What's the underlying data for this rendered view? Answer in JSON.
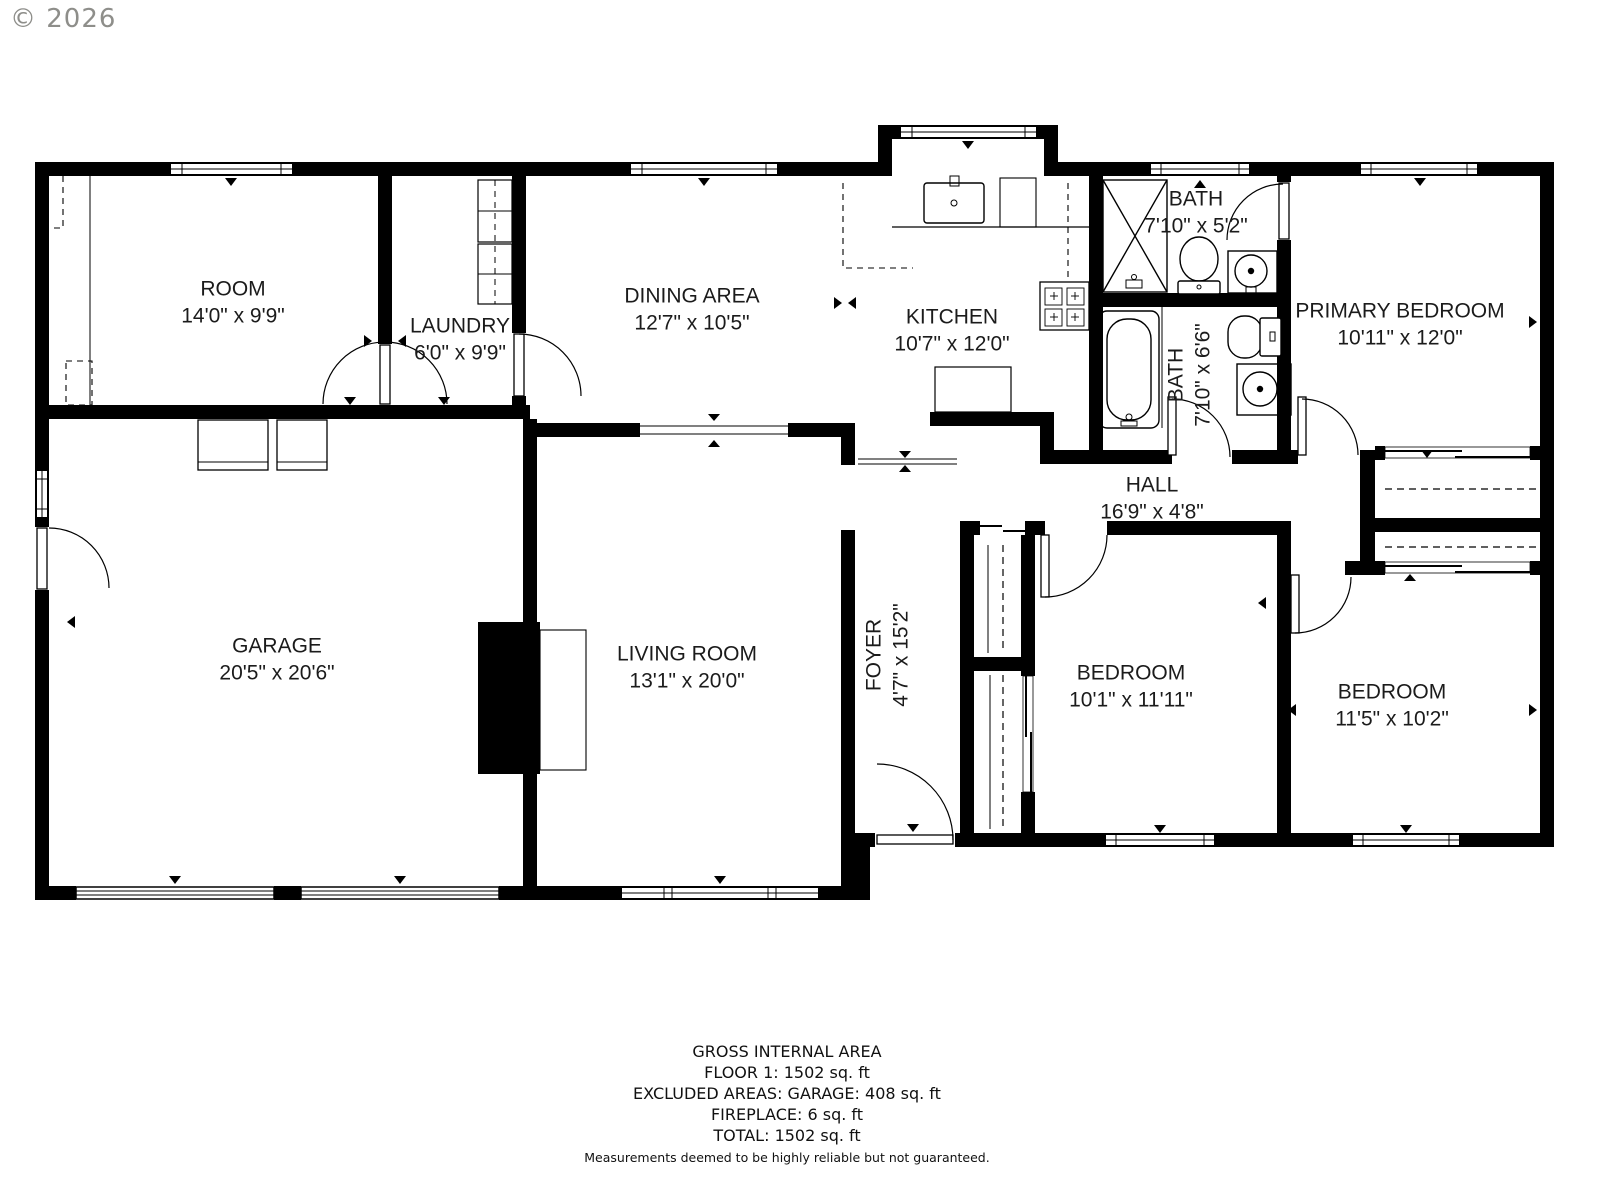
{
  "copyright": "© 2026",
  "rooms": [
    {
      "name": "ROOM",
      "dims": "14'0\" x 9'9\""
    },
    {
      "name": "LAUNDRY",
      "dims": "6'0\" x 9'9\""
    },
    {
      "name": "DINING AREA",
      "dims": "12'7\" x 10'5\""
    },
    {
      "name": "KITCHEN",
      "dims": "10'7\" x 12'0\""
    },
    {
      "name": "BATH",
      "dims": "7'10\" x 5'2\""
    },
    {
      "name": "PRIMARY BEDROOM",
      "dims": "10'11\" x 12'0\""
    },
    {
      "name": "BATH",
      "dims": "7'10\" x 6'6\""
    },
    {
      "name": "HALL",
      "dims": "16'9\" x 4'8\""
    },
    {
      "name": "GARAGE",
      "dims": "20'5\" x 20'6\""
    },
    {
      "name": "LIVING ROOM",
      "dims": "13'1\" x 20'0\""
    },
    {
      "name": "FOYER",
      "dims": "4'7\" x 15'2\""
    },
    {
      "name": "BEDROOM",
      "dims": "10'1\" x 11'11\""
    },
    {
      "name": "BEDROOM",
      "dims": "11'5\" x 10'2\""
    }
  ],
  "footer": {
    "line1": "GROSS INTERNAL AREA",
    "line2": "FLOOR 1: 1502 sq. ft",
    "line3": "EXCLUDED AREAS: GARAGE: 408 sq. ft",
    "line4": "FIREPLACE: 6 sq. ft",
    "line5": "TOTAL: 1502 sq. ft",
    "disclaimer": "Measurements deemed to be highly reliable but not guaranteed."
  }
}
